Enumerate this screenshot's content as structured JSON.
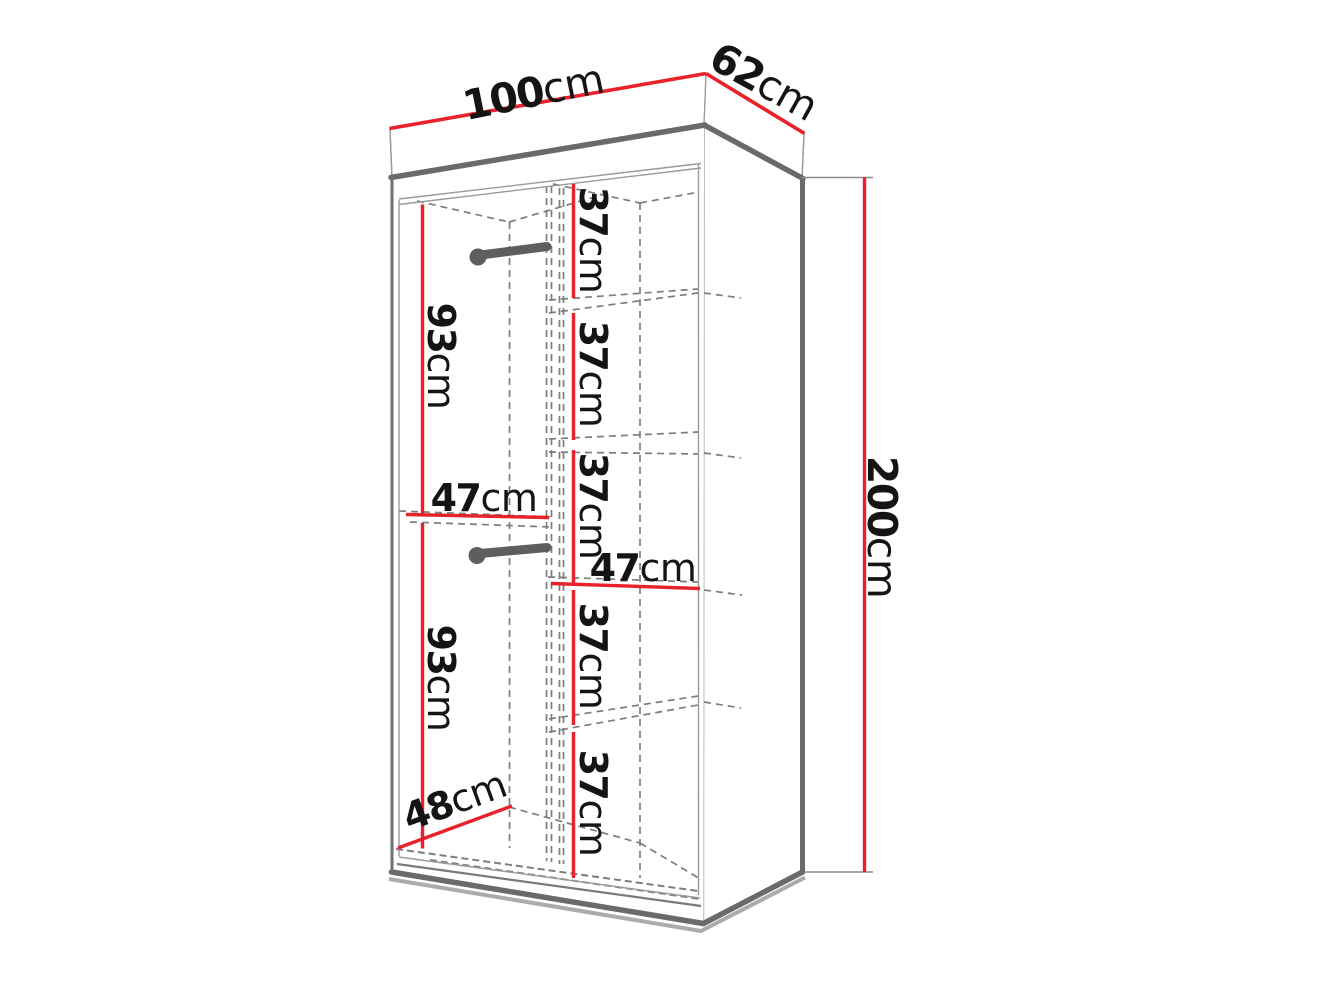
{
  "diagram": {
    "title": "Wardrobe dimension diagram",
    "subject": "two-section wardrobe with hanging rods and shelves, line drawing with red dimension lines",
    "dims": {
      "width": {
        "value": "100",
        "unit": "cm"
      },
      "depth": {
        "value": "62",
        "unit": "cm"
      },
      "height": {
        "value": "200",
        "unit": "cm"
      },
      "hanging_top": {
        "value": "93",
        "unit": "cm"
      },
      "hanging_bottom": {
        "value": "93",
        "unit": "cm"
      },
      "hanging_width": {
        "value": "47",
        "unit": "cm"
      },
      "shelf_width": {
        "value": "47",
        "unit": "cm"
      },
      "interior_depth": {
        "value": "48",
        "unit": "cm"
      },
      "shelf_sections": [
        {
          "value": "37",
          "unit": "cm"
        },
        {
          "value": "37",
          "unit": "cm"
        },
        {
          "value": "37",
          "unit": "cm"
        },
        {
          "value": "37",
          "unit": "cm"
        },
        {
          "value": "37",
          "unit": "cm"
        }
      ]
    },
    "colors": {
      "dimension_red": "#e8212b",
      "outline_gray": "#6a6a6a",
      "dashed_gray": "#7d7d7d",
      "rod_gray": "#5e5e5e",
      "background": "#ffffff"
    }
  }
}
